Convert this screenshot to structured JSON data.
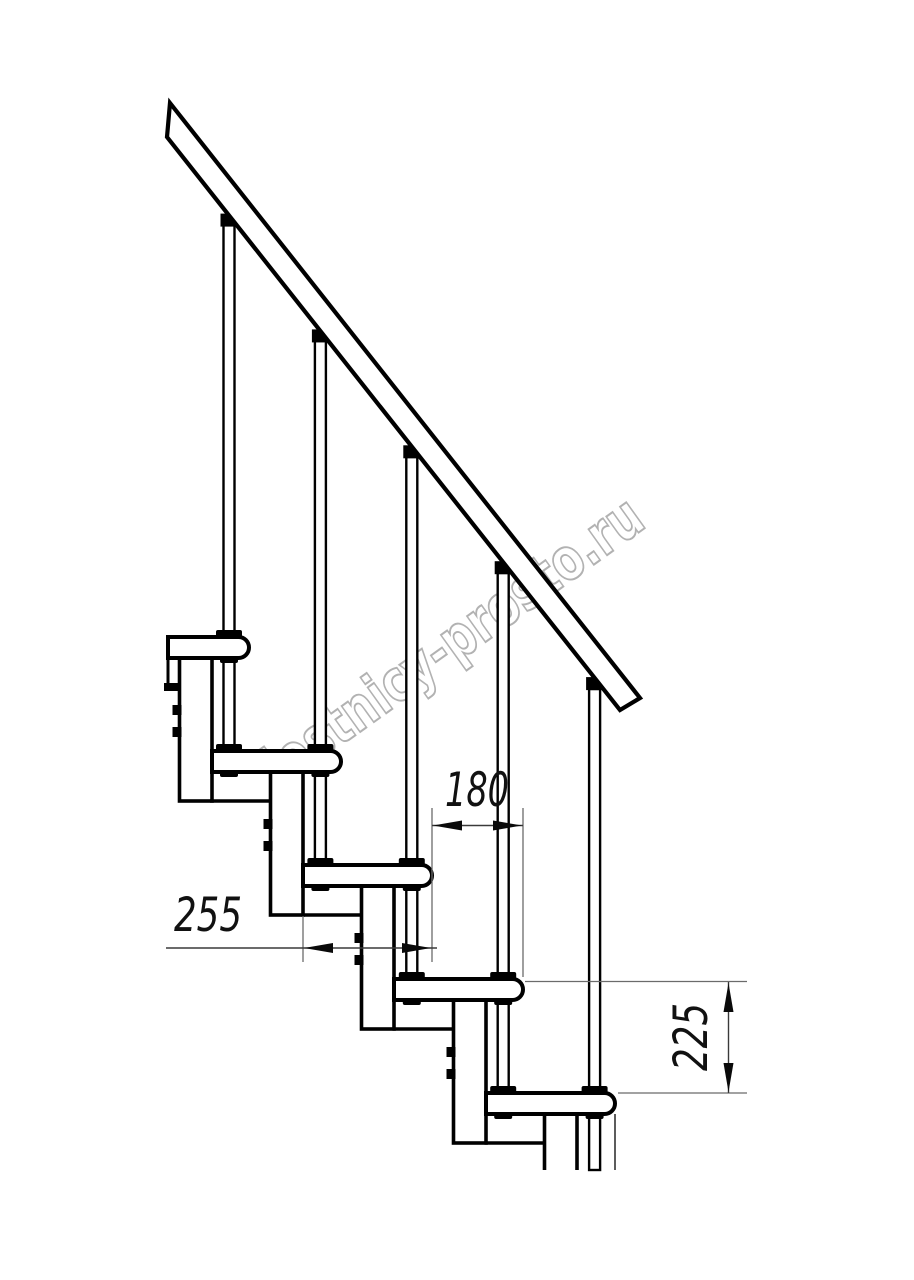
{
  "document": {
    "kind": "staircase-side-view-technical-drawing",
    "background_color": "#ffffff",
    "line_color": "#000000",
    "dimension_line_color": "#3a3a3a",
    "extension_line_color": "#6b6b6b"
  },
  "dimensions": {
    "run": {
      "label": "180",
      "meaning": "horizontal step run between balusters"
    },
    "depth": {
      "label": "255",
      "meaning": "tread depth"
    },
    "rise": {
      "label": "225",
      "meaning": "vertical rise between treads"
    }
  },
  "watermark": {
    "text": "lestnicy-prosto.ru",
    "color": "#b2b2b2"
  },
  "structure": {
    "treads_visible": 5,
    "balusters_visible": 5,
    "support_modules_visible": 5,
    "handrail": "diagonal band upper left to middle right"
  }
}
